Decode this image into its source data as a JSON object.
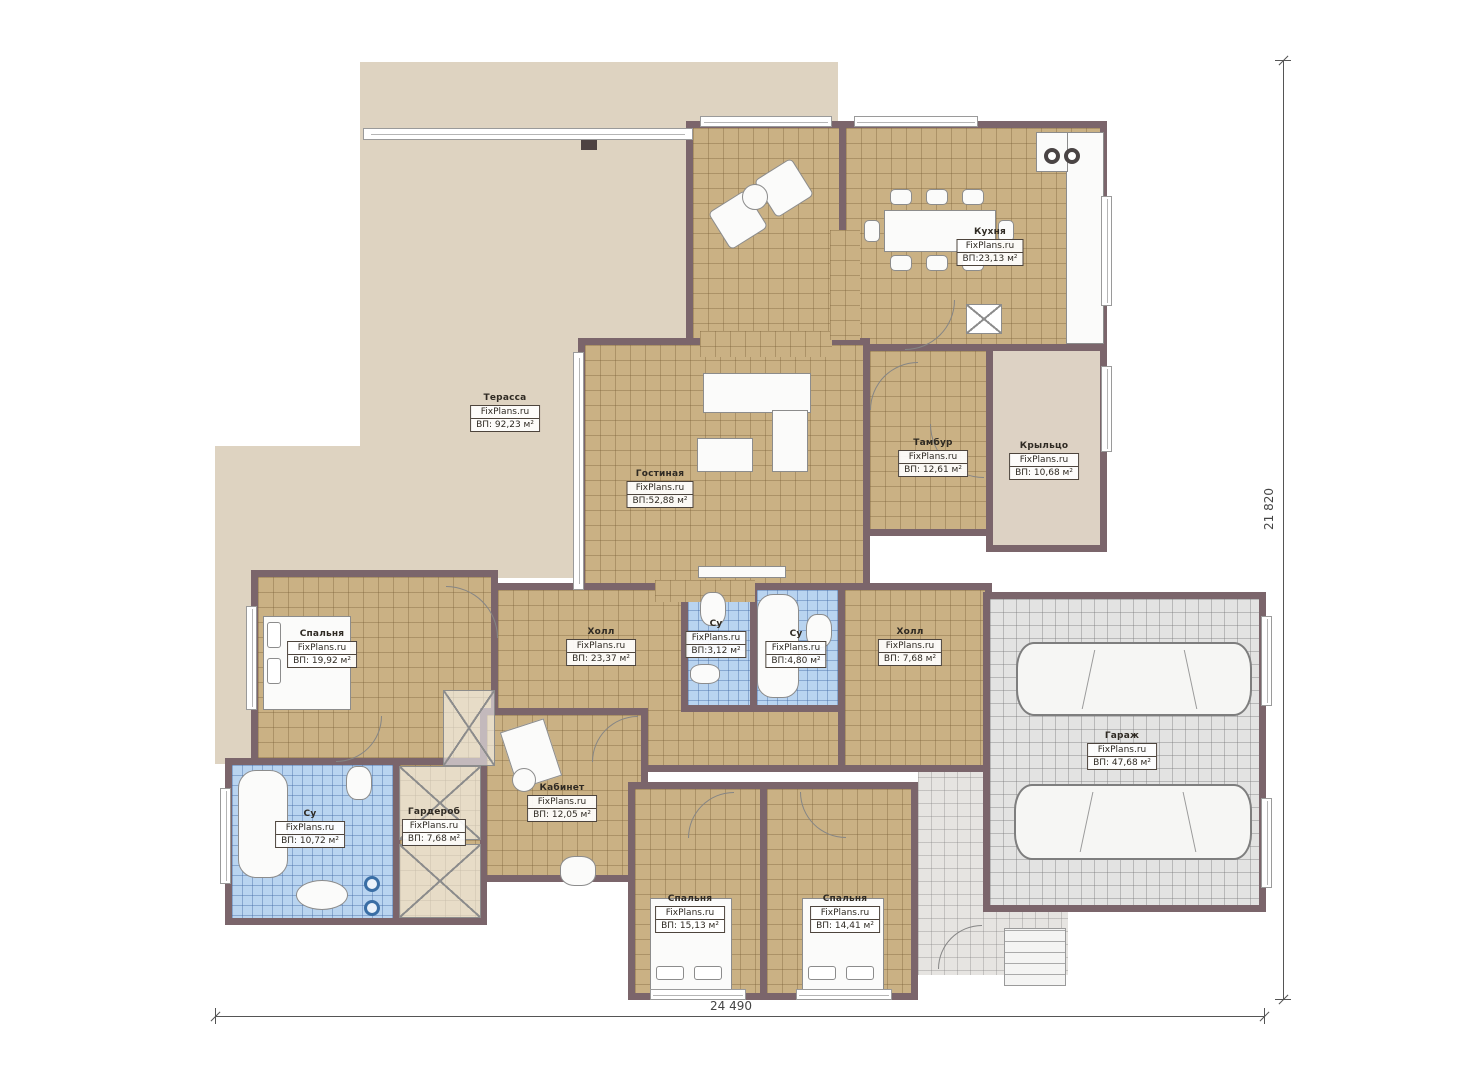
{
  "plan": {
    "brand": "FixPlans.ru",
    "dimensions": {
      "width_label": "24 490",
      "height_label": "21 820"
    }
  },
  "rooms": [
    {
      "name": "Терасса",
      "area": "ВП: 92,23 м²"
    },
    {
      "name": "Кухня",
      "area": "ВП:23,13 м²"
    },
    {
      "name": "Гостиная",
      "area": "ВП:52,88 м²"
    },
    {
      "name": "Тамбур",
      "area": "ВП: 12,61 м²"
    },
    {
      "name": "Крыльцо",
      "area": "ВП: 10,68 м²"
    },
    {
      "name": "Холл",
      "area": "ВП: 23,37 м²"
    },
    {
      "name": "Су",
      "area": "ВП:3,12 м²"
    },
    {
      "name": "Су",
      "area": "ВП:4,80 м²"
    },
    {
      "name": "Холл",
      "area": "ВП: 7,68 м²"
    },
    {
      "name": "Спальня",
      "area": "ВП: 19,92 м²"
    },
    {
      "name": "Су",
      "area": "ВП: 10,72 м²"
    },
    {
      "name": "Гардероб",
      "area": "ВП: 7,68 м²"
    },
    {
      "name": "Кабинет",
      "area": "ВП: 12,05 м²"
    },
    {
      "name": "Спальня",
      "area": "ВП: 15,13 м²"
    },
    {
      "name": "Спальня",
      "area": "ВП: 14,41 м²"
    },
    {
      "name": "Гараж",
      "area": "ВП: 47,68 м²"
    }
  ]
}
